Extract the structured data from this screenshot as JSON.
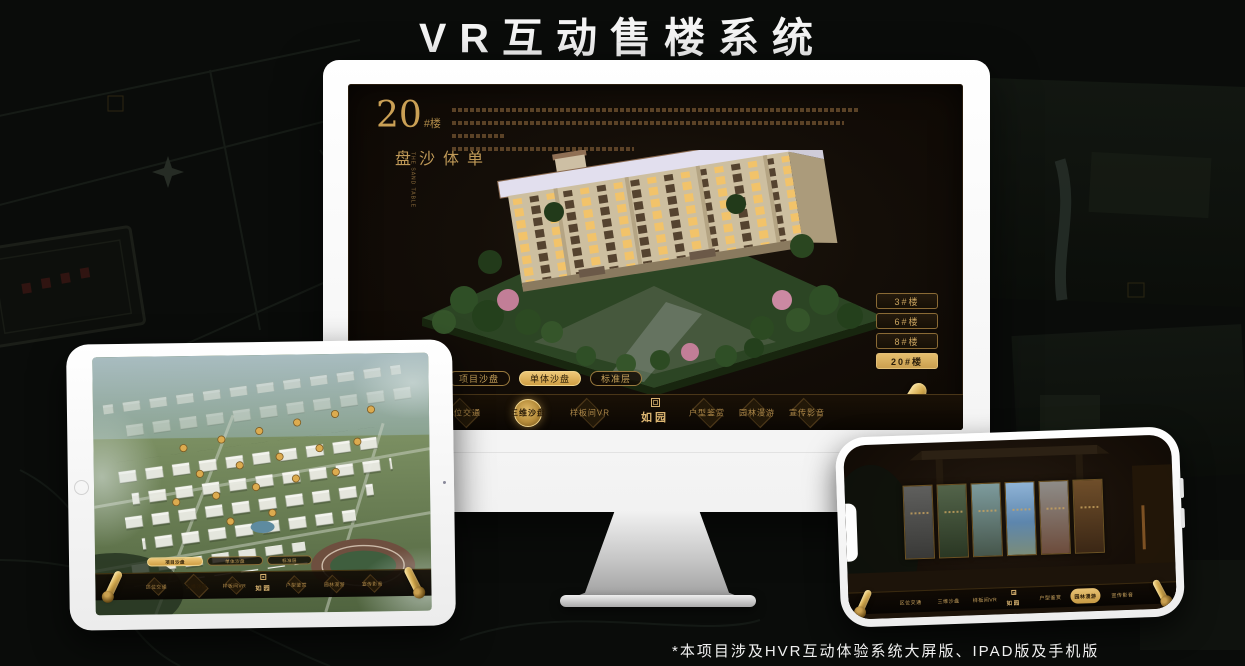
{
  "page": {
    "title": "VR互动售楼系统",
    "footnote": "*本项目涉及HVR互动体验系统大屏版、IPAD版及手机版"
  },
  "colors": {
    "accent_gold": "#C89B55",
    "active_gold_bg": "#D9AE5F",
    "screen_bg": "#140E08",
    "title_white": "#F5F5F5",
    "ipad_sky": "#9FB3B8",
    "estate_green": "#6F8A50"
  },
  "monitor": {
    "headline": {
      "number": "20",
      "suffix": "#楼",
      "vertical_title": "单体沙盘",
      "english": "THE SAND TABLE"
    },
    "floor_buttons": [
      {
        "label": "3#楼",
        "active": false
      },
      {
        "label": "6#楼",
        "active": false
      },
      {
        "label": "8#楼",
        "active": false
      },
      {
        "label": "20#楼",
        "active": true
      }
    ],
    "subtabs": [
      {
        "label": "项目沙盘",
        "active": false
      },
      {
        "label": "单体沙盘",
        "active": true
      },
      {
        "label": "标准层",
        "active": false
      }
    ],
    "nav": {
      "logo": "如园",
      "items": [
        {
          "label": "区位交通",
          "active": false
        },
        {
          "label": "三维沙盘",
          "active": true
        },
        {
          "label": "样板间VR",
          "active": false
        },
        {
          "label": "户型鉴赏",
          "active": false
        },
        {
          "label": "园林漫游",
          "active": false
        },
        {
          "label": "宣传影音",
          "active": false
        }
      ]
    }
  },
  "ipad": {
    "subtabs": [
      {
        "label": "项目沙盘",
        "active": true
      },
      {
        "label": "单体沙盘",
        "active": false
      },
      {
        "label": "标准层",
        "active": false
      }
    ],
    "nav": {
      "logo": "如园",
      "items": [
        {
          "label": "区位交通",
          "active": false
        },
        {
          "label": "三维沙盘",
          "active": true
        },
        {
          "label": "样板间VR",
          "active": false
        },
        {
          "label": "户型鉴赏",
          "active": false
        },
        {
          "label": "园林漫游",
          "active": false
        },
        {
          "label": "宣传影音",
          "active": false
        }
      ]
    }
  },
  "phone": {
    "nav": {
      "logo": "如园",
      "items": [
        {
          "label": "区位交通",
          "active": false
        },
        {
          "label": "三维沙盘",
          "active": false
        },
        {
          "label": "样板间VR",
          "active": false
        },
        {
          "label": "户型鉴赏",
          "active": false
        },
        {
          "label": "园林漫游",
          "active": true
        },
        {
          "label": "宣传影音",
          "active": false
        }
      ]
    }
  }
}
